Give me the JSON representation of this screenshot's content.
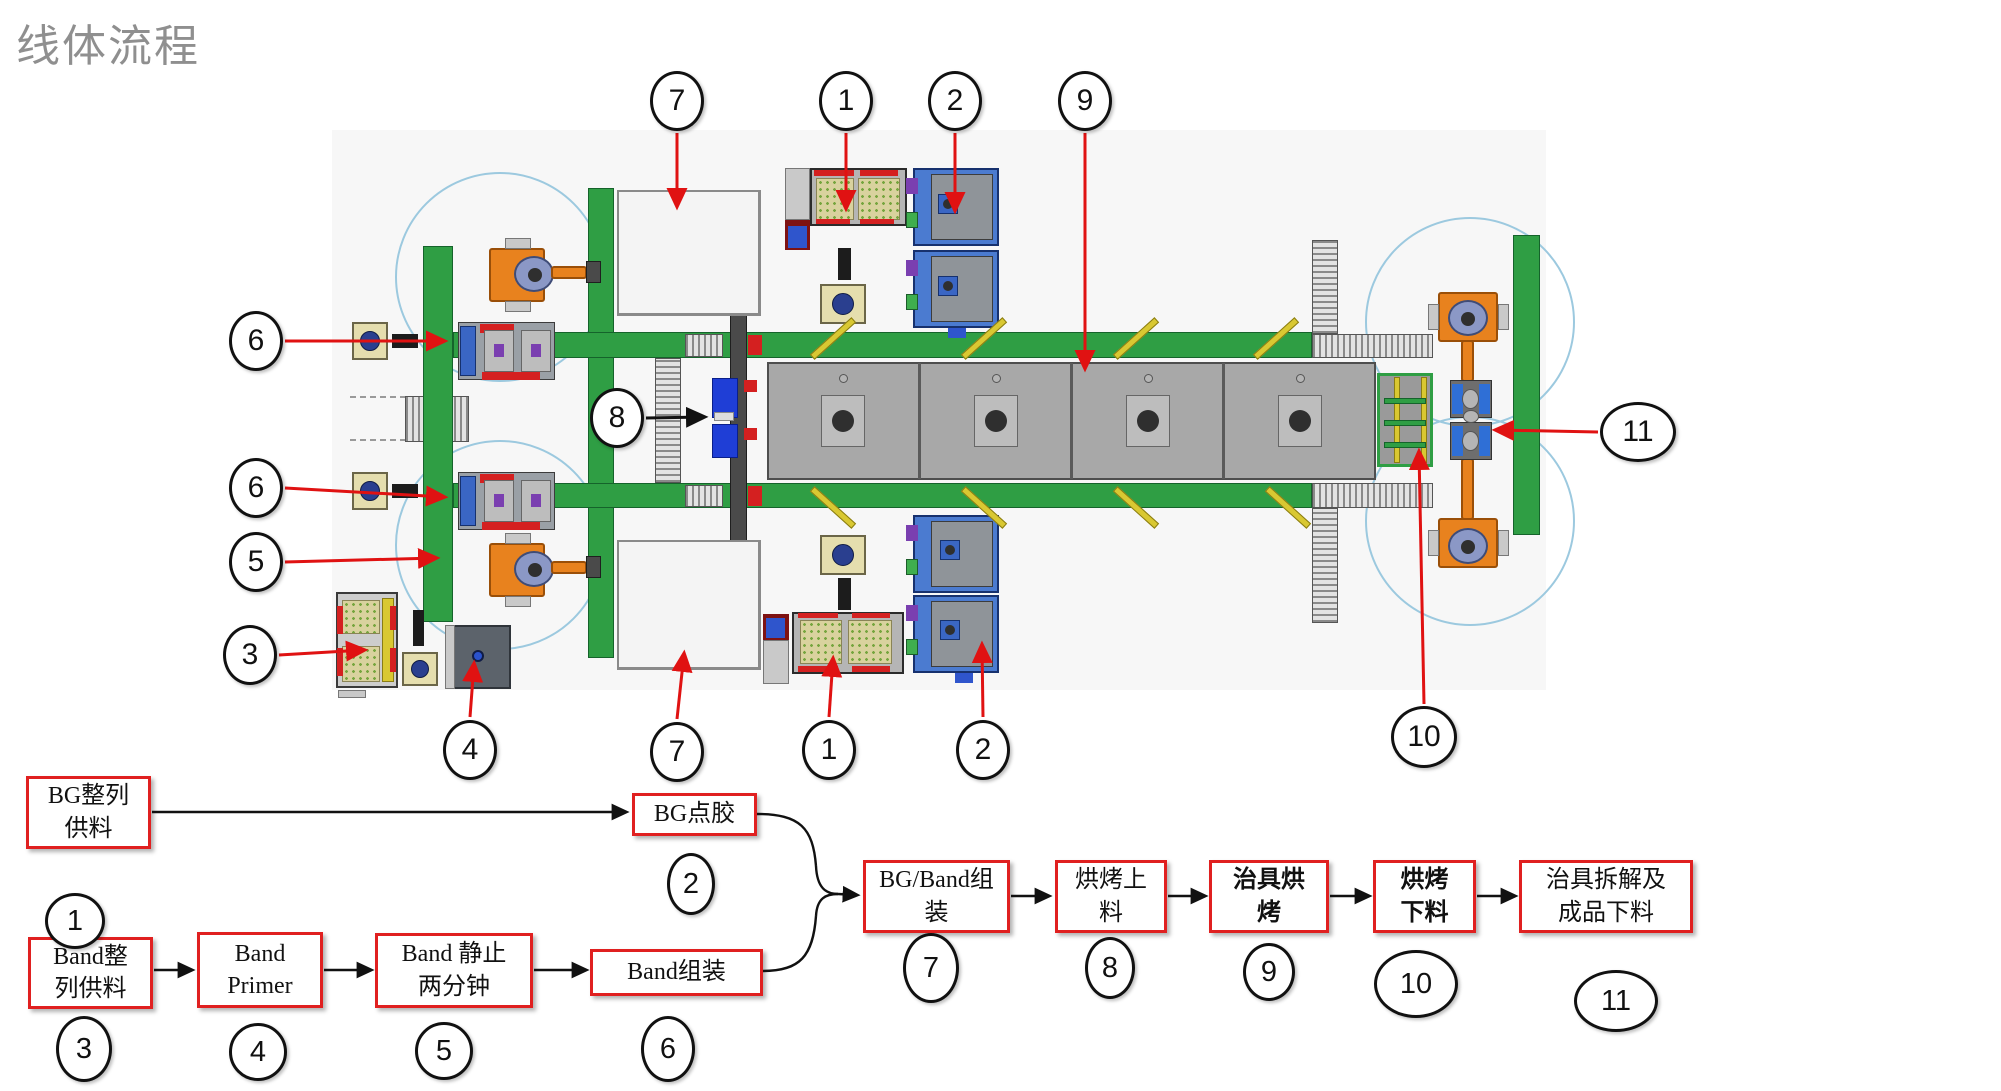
{
  "title": "线体流程",
  "colors": {
    "title_gray": "#8f8f8f",
    "callout_arrow_red": "#e01212",
    "flow_box_border_red": "#e02020",
    "conveyor_green": "#2f9e44",
    "oven_gray": "#a8a8a8",
    "robot_orange": "#e8821e",
    "machine_blue": "#4b7bd0"
  },
  "diagram": {
    "machine_callouts": [
      {
        "n": "7"
      },
      {
        "n": "1"
      },
      {
        "n": "2"
      },
      {
        "n": "9"
      },
      {
        "n": "6"
      },
      {
        "n": "8"
      },
      {
        "n": "6"
      },
      {
        "n": "5"
      },
      {
        "n": "3"
      },
      {
        "n": "4"
      },
      {
        "n": "7"
      },
      {
        "n": "1"
      },
      {
        "n": "2"
      },
      {
        "n": "10"
      },
      {
        "n": "11"
      }
    ],
    "flow_steps": [
      {
        "n": "1",
        "label": "BG整列供料",
        "lines": [
          "BG整列",
          "供料"
        ],
        "bold": false
      },
      {
        "n": "2",
        "label": "BG点胶",
        "lines": [
          "BG点胶"
        ],
        "bold": false
      },
      {
        "n": "3",
        "label": "Band整列供料",
        "lines": [
          "Band整",
          "列供料"
        ],
        "bold": false
      },
      {
        "n": "4",
        "label": "Band Primer",
        "lines": [
          "Band",
          "Primer"
        ],
        "bold": false
      },
      {
        "n": "5",
        "label": "Band 静止两分钟",
        "lines": [
          "Band 静止",
          "两分钟"
        ],
        "bold": false
      },
      {
        "n": "6",
        "label": "Band组装",
        "lines": [
          "Band组装"
        ],
        "bold": false
      },
      {
        "n": "7",
        "label": "BG/Band组装",
        "lines": [
          "BG/Band组",
          "装"
        ],
        "bold": false
      },
      {
        "n": "8",
        "label": "烘烤上料",
        "lines": [
          "烘烤上",
          "料"
        ],
        "bold": false
      },
      {
        "n": "9",
        "label": "治具烘烤",
        "lines": [
          "治具烘",
          "烤"
        ],
        "bold": true
      },
      {
        "n": "10",
        "label": "烘烤下料",
        "lines": [
          "烘烤",
          "下料"
        ],
        "bold": true
      },
      {
        "n": "11",
        "label": "治具拆解及成品下料",
        "lines": [
          "治具拆解及",
          "成品下料"
        ],
        "bold": false
      }
    ],
    "flow_connections": [
      [
        "1",
        "2"
      ],
      [
        "2",
        "7"
      ],
      [
        "3",
        "4"
      ],
      [
        "4",
        "5"
      ],
      [
        "5",
        "6"
      ],
      [
        "6",
        "7"
      ],
      [
        "7",
        "8"
      ],
      [
        "8",
        "9"
      ],
      [
        "9",
        "10"
      ],
      [
        "10",
        "11"
      ]
    ]
  }
}
